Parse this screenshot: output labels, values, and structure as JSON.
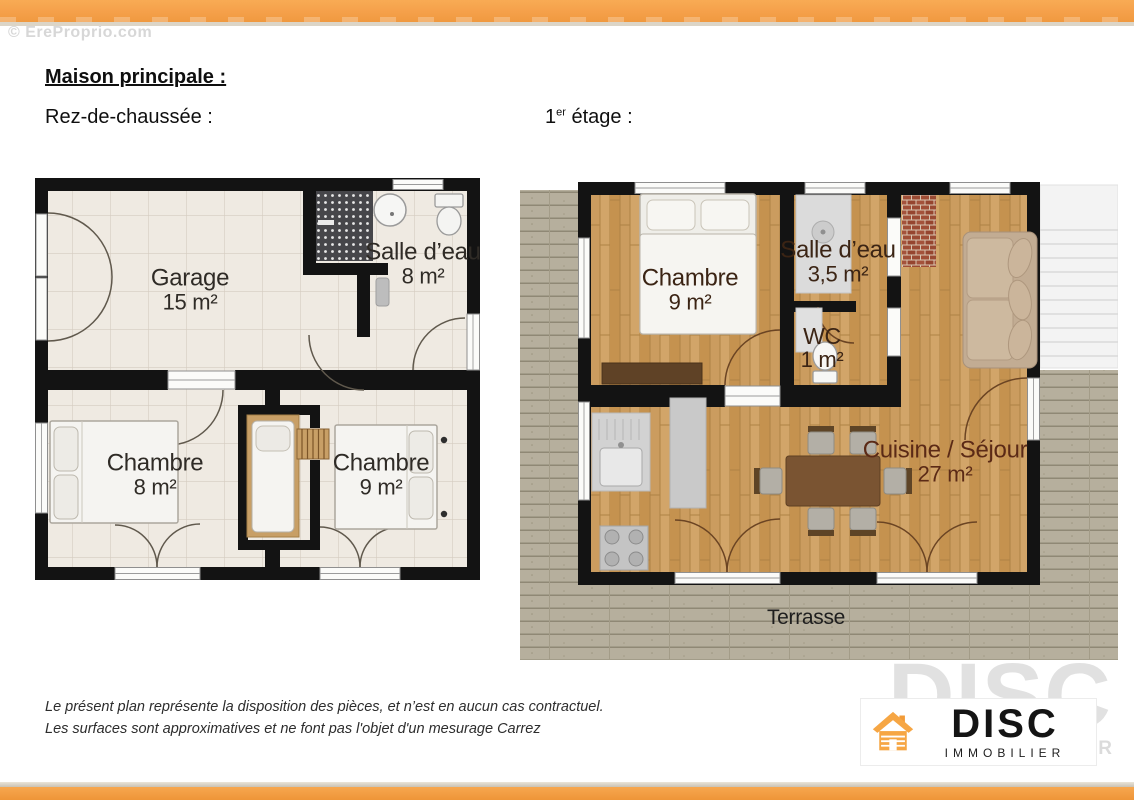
{
  "watermark": "© EreProprio.com",
  "header": {
    "title": "Maison principale :",
    "ground_floor": "Rez-de-chaussée :",
    "first_floor": {
      "num": "1",
      "sup": "er",
      "rest": " étage :"
    }
  },
  "ground": {
    "rooms": [
      {
        "id": "garage",
        "label": "Garage",
        "area": "15 m²"
      },
      {
        "id": "salle-deau",
        "label": "Salle d’eau",
        "area": "8 m²"
      },
      {
        "id": "chambre-1",
        "label": "Chambre",
        "area": "8 m²"
      },
      {
        "id": "chambre-2",
        "label": "Chambre",
        "area": "9 m²"
      }
    ]
  },
  "first": {
    "rooms": [
      {
        "id": "chambre",
        "label": "Chambre",
        "area": "9 m²"
      },
      {
        "id": "salle-deau",
        "label": "Salle d’eau",
        "area": "3,5 m²"
      },
      {
        "id": "wc",
        "label": "WC",
        "area": "1 m²"
      },
      {
        "id": "cuisine-sejour",
        "label": "Cuisine / Séjour",
        "area": "27 m²"
      },
      {
        "id": "terrasse",
        "label": "Terrasse"
      }
    ]
  },
  "disclaimer": {
    "line1": "Le présent plan représente la disposition des pièces, et n’est en aucun cas contractuel.",
    "line2": "Les surfaces sont approximatives et ne font pas l'objet d'un mesurage Carrez"
  },
  "logo": {
    "brand": "DISC",
    "subtitle": "IMMOBILIER",
    "watermark_brand": "DISC",
    "watermark_subtitle": "IMMOBILIER"
  },
  "colors": {
    "accent_orange": "#F5A04A",
    "wall_black": "#131313",
    "wood_floor": "#CB9C5F",
    "deck_gray": "#B6AF9D",
    "tile_beige": "#EFEAE2"
  }
}
